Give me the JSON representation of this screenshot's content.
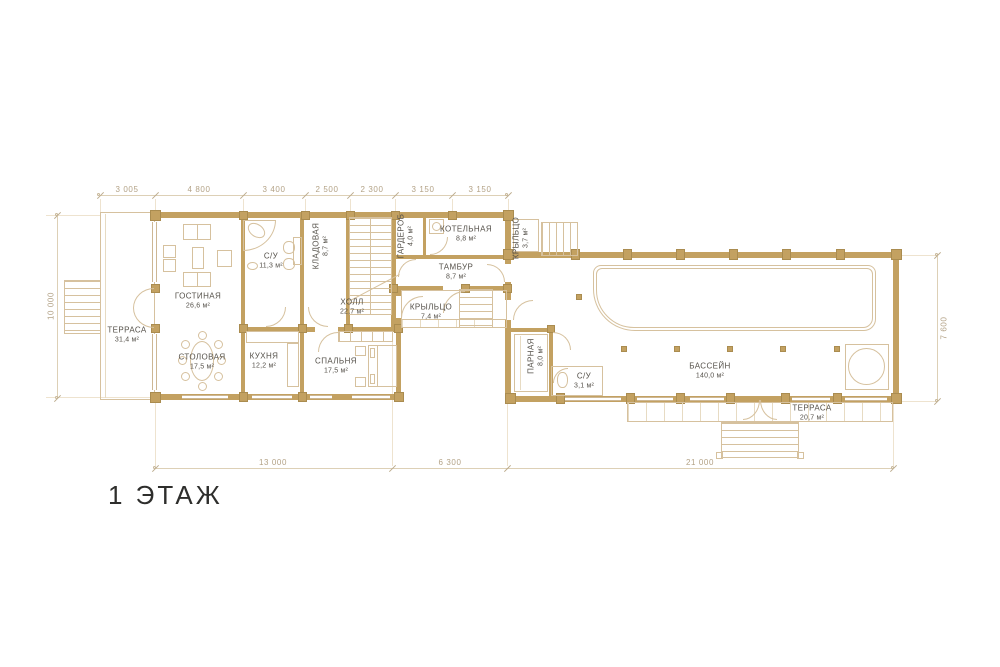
{
  "title": "1 ЭТАЖ",
  "dimensions": {
    "top": [
      "3 005",
      "4 800",
      "3 400",
      "2 500",
      "2 300",
      "3 150",
      "3 150"
    ],
    "bottom": [
      "13 000",
      "6 300",
      "21 000"
    ],
    "left": "10 000",
    "right": "7 600"
  },
  "rooms": {
    "terrace_left": {
      "name": "ТЕРРАСА",
      "area": "31,4 м²"
    },
    "living": {
      "name": "ГОСТИНАЯ",
      "area": "26,6 м²"
    },
    "bath1": {
      "name": "С/У",
      "area": "11,3 м²"
    },
    "storage": {
      "name": "КЛАДОВАЯ",
      "area": "8,7 м²"
    },
    "wardrobe": {
      "name": "ГАРДЕРОБ",
      "area": "4,0 м²"
    },
    "boiler": {
      "name": "КОТЕЛЬНАЯ",
      "area": "8,8 м²"
    },
    "tambour": {
      "name": "ТАМБУР",
      "area": "8,7 м²"
    },
    "porch_small": {
      "name": "КРЫЛЬЦО",
      "area": "3,7 м²"
    },
    "hall": {
      "name": "ХОЛЛ",
      "area": "22,7 м²"
    },
    "porch_mid": {
      "name": "КРЫЛЬЦО",
      "area": "7,4 м²"
    },
    "dining": {
      "name": "СТОЛОВАЯ",
      "area": "17,5 м²"
    },
    "kitchen": {
      "name": "КУХНЯ",
      "area": "12,2 м²"
    },
    "bedroom": {
      "name": "СПАЛЬНЯ",
      "area": "17,5 м²"
    },
    "steam": {
      "name": "ПАРНАЯ",
      "area": "8,0 м²"
    },
    "bath2": {
      "name": "С/У",
      "area": "3,1 м²"
    },
    "pool": {
      "name": "БАССЕЙН",
      "area": "140,0 м²"
    },
    "terrace_pool": {
      "name": "ТЕРРАСА",
      "area": "20,7 м²"
    }
  },
  "colors": {
    "wall": "#c3a161",
    "thin_line": "#d6c19e",
    "dim_text": "#b3a286",
    "room_text": "#55514a",
    "title_text": "#2e2e2c"
  }
}
